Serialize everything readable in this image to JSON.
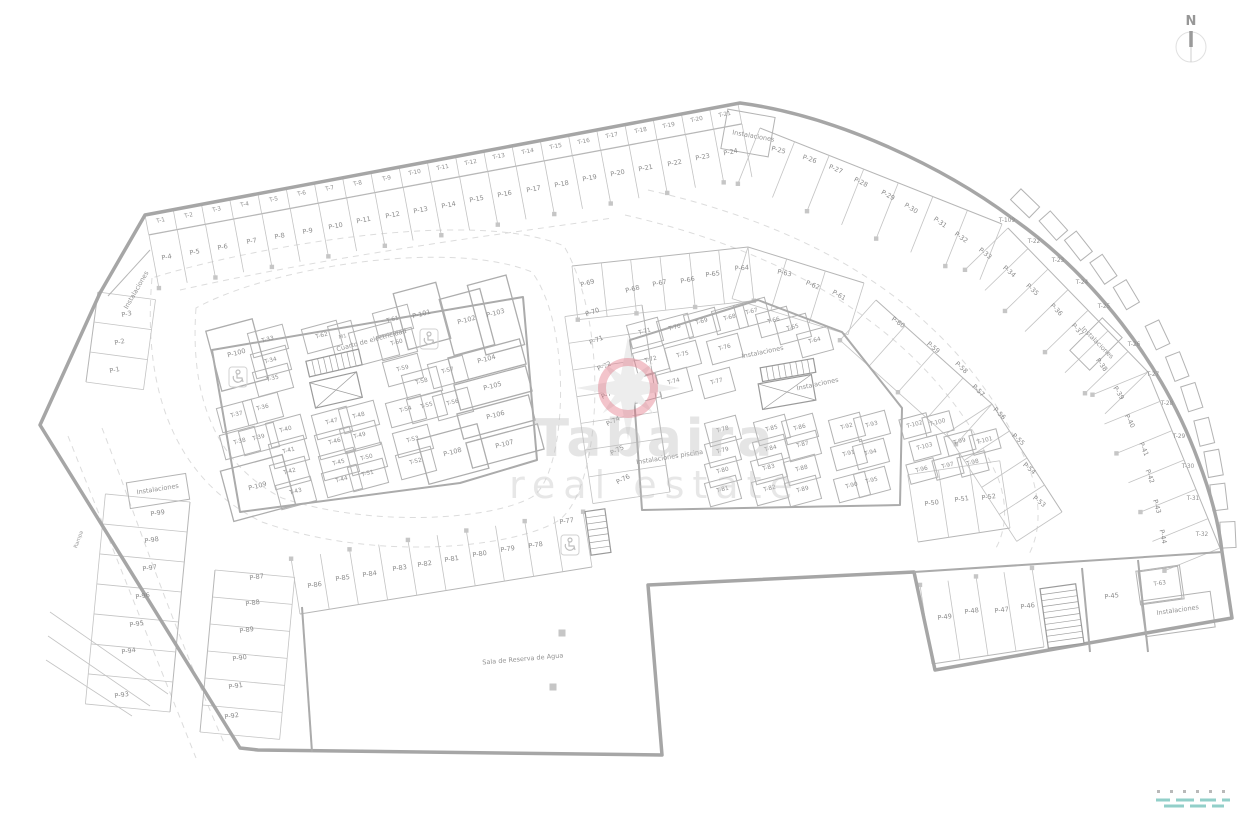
{
  "watermark": {
    "name": "Tabaira",
    "tagline": "real estate"
  },
  "compass": {
    "label": "N"
  },
  "plan": {
    "parking": [
      [
        "P-1",
        115,
        372,
        -12
      ],
      [
        "P-2",
        120,
        344,
        -12
      ],
      [
        "P-3",
        127,
        316,
        -12
      ],
      [
        "P-4",
        167,
        259,
        -11
      ],
      [
        "P-5",
        195,
        254,
        -11
      ],
      [
        "P-6",
        223,
        249,
        -11
      ],
      [
        "P-7",
        252,
        243,
        -11
      ],
      [
        "P-8",
        280,
        238,
        -11
      ],
      [
        "P-9",
        308,
        233,
        -11
      ],
      [
        "P-10",
        336,
        228,
        -11
      ],
      [
        "P-11",
        364,
        222,
        -11
      ],
      [
        "P-12",
        393,
        217,
        -11
      ],
      [
        "P-13",
        421,
        212,
        -11
      ],
      [
        "P-14",
        449,
        207,
        -11
      ],
      [
        "P-15",
        477,
        201,
        -11
      ],
      [
        "P-16",
        505,
        196,
        -11
      ],
      [
        "P-17",
        534,
        191,
        -11
      ],
      [
        "P-18",
        562,
        186,
        -11
      ],
      [
        "P-19",
        590,
        180,
        -11
      ],
      [
        "P-20",
        618,
        175,
        -11
      ],
      [
        "P-21",
        646,
        170,
        -11
      ],
      [
        "P-22",
        675,
        165,
        -11
      ],
      [
        "P-23",
        703,
        159,
        -11
      ],
      [
        "P-24",
        731,
        154,
        -11
      ],
      [
        "P-25",
        778,
        152,
        14
      ],
      [
        "P-26",
        809,
        161,
        18
      ],
      [
        "P-27",
        835,
        171,
        22
      ],
      [
        "P-28",
        860,
        184,
        26
      ],
      [
        "P-29",
        887,
        197,
        29
      ],
      [
        "P-30",
        910,
        210,
        32
      ],
      [
        "P-31",
        939,
        224,
        35
      ],
      [
        "P-32",
        960,
        239,
        36
      ],
      [
        "P-33",
        984,
        255,
        38
      ],
      [
        "P-34",
        1008,
        273,
        40
      ],
      [
        "P-35",
        1031,
        291,
        43
      ],
      [
        "P-36",
        1055,
        311,
        46
      ],
      [
        "P-37",
        1076,
        331,
        49
      ],
      [
        "P-38",
        1100,
        366,
        53
      ],
      [
        "P-39",
        1117,
        394,
        58
      ],
      [
        "P-40",
        1128,
        422,
        62
      ],
      [
        "P-41",
        1142,
        450,
        66
      ],
      [
        "P-42",
        1148,
        477,
        70
      ],
      [
        "P-43",
        1155,
        507,
        74
      ],
      [
        "P-44",
        1161,
        537,
        78
      ],
      [
        "P-45",
        1112,
        598,
        -8
      ],
      [
        "P-46",
        1028,
        608,
        -8
      ],
      [
        "P-47",
        1002,
        612,
        -8
      ],
      [
        "P-48",
        972,
        613,
        -8
      ],
      [
        "P-49",
        945,
        619,
        -8
      ],
      [
        "P-50",
        932,
        505,
        -8
      ],
      [
        "P-51",
        962,
        501,
        -8
      ],
      [
        "P-52",
        989,
        499,
        -8
      ],
      [
        "P-53",
        1038,
        503,
        38
      ],
      [
        "P-54",
        1028,
        470,
        40
      ],
      [
        "P-55",
        1017,
        441,
        42
      ],
      [
        "P-56",
        998,
        415,
        44
      ],
      [
        "P-57",
        977,
        392,
        45
      ],
      [
        "P-58",
        960,
        369,
        43
      ],
      [
        "P-59",
        932,
        349,
        40
      ],
      [
        "P-60",
        897,
        324,
        36
      ],
      [
        "P-61",
        838,
        297,
        30
      ],
      [
        "P-62",
        812,
        287,
        22
      ],
      [
        "P-63",
        784,
        275,
        12
      ],
      [
        "P-64",
        742,
        270,
        -4
      ],
      [
        "P-65",
        713,
        276,
        -8
      ],
      [
        "P-66",
        688,
        282,
        -11
      ],
      [
        "P-67",
        660,
        285,
        -13
      ],
      [
        "P-68",
        633,
        291,
        -15
      ],
      [
        "P-69",
        588,
        285,
        -16
      ],
      [
        "P-70",
        593,
        314,
        -20
      ],
      [
        "P-71",
        597,
        342,
        -22
      ],
      [
        "P-72",
        605,
        368,
        -24
      ],
      [
        "P-73",
        609,
        396,
        -25
      ],
      [
        "P-74",
        614,
        423,
        -26
      ],
      [
        "P-75",
        618,
        452,
        -27
      ],
      [
        "P-76",
        624,
        481,
        -28
      ],
      [
        "P-77",
        567,
        523,
        -9
      ],
      [
        "P-78",
        536,
        547,
        -9
      ],
      [
        "P-79",
        508,
        551,
        -9
      ],
      [
        "P-80",
        480,
        556,
        -9
      ],
      [
        "P-81",
        452,
        561,
        -9
      ],
      [
        "P-82",
        425,
        566,
        -9
      ],
      [
        "P-83",
        400,
        570,
        -9
      ],
      [
        "P-84",
        370,
        576,
        -9
      ],
      [
        "P-85",
        343,
        580,
        -9
      ],
      [
        "P-86",
        315,
        587,
        -9
      ],
      [
        "P-87",
        257,
        579,
        -9
      ],
      [
        "P-88",
        253,
        605,
        -9
      ],
      [
        "P-89",
        247,
        632,
        -9
      ],
      [
        "P-90",
        240,
        660,
        -9
      ],
      [
        "P-91",
        236,
        688,
        -9
      ],
      [
        "P-92",
        232,
        718,
        -9
      ],
      [
        "P-93",
        122,
        697,
        -9
      ],
      [
        "P-94",
        129,
        653,
        -9
      ],
      [
        "P-95",
        137,
        626,
        -9
      ],
      [
        "P-96",
        143,
        598,
        -9
      ],
      [
        "P-97",
        150,
        570,
        -9
      ],
      [
        "P-98",
        152,
        542,
        -9
      ],
      [
        "P-99",
        158,
        515,
        -9
      ],
      [
        "P-100",
        237,
        355,
        -15
      ],
      [
        "P-101",
        422,
        316,
        -15
      ],
      [
        "P-102",
        467,
        322,
        -15
      ],
      [
        "P-103",
        496,
        315,
        -15
      ],
      [
        "P-104",
        487,
        361,
        -15
      ],
      [
        "P-105",
        493,
        388,
        -15
      ],
      [
        "P-106",
        496,
        417,
        -15
      ],
      [
        "P-107",
        505,
        446,
        -15
      ],
      [
        "P-108",
        453,
        454,
        -15
      ],
      [
        "P-109",
        258,
        488,
        -15
      ]
    ],
    "storage": [
      [
        "T-1",
        161,
        222,
        -11
      ],
      [
        "T-2",
        189,
        217,
        -11
      ],
      [
        "T-3",
        217,
        211,
        -11
      ],
      [
        "T-4",
        245,
        206,
        -11
      ],
      [
        "T-5",
        274,
        201,
        -11
      ],
      [
        "T-6",
        302,
        195,
        -11
      ],
      [
        "T-7",
        330,
        190,
        -11
      ],
      [
        "T-8",
        358,
        185,
        -11
      ],
      [
        "T-9",
        387,
        180,
        -11
      ],
      [
        "T-10",
        415,
        174,
        -11
      ],
      [
        "T-11",
        443,
        169,
        -11
      ],
      [
        "T-12",
        471,
        164,
        -11
      ],
      [
        "T-13",
        499,
        158,
        -11
      ],
      [
        "T-14",
        528,
        153,
        -11
      ],
      [
        "T-15",
        556,
        148,
        -11
      ],
      [
        "T-16",
        584,
        143,
        -11
      ],
      [
        "T-17",
        612,
        137,
        -11
      ],
      [
        "T-18",
        641,
        132,
        -11
      ],
      [
        "T-19",
        669,
        127,
        -11
      ],
      [
        "T-20",
        697,
        121,
        -11
      ],
      [
        "T-21",
        725,
        116,
        -11
      ],
      [
        "T-22",
        1034,
        243,
        0
      ],
      [
        "T-23",
        1058,
        262,
        0
      ],
      [
        "T-24",
        1082,
        284,
        0
      ],
      [
        "T-25",
        1104,
        308,
        0
      ],
      [
        "T-26",
        1134,
        346,
        0
      ],
      [
        "T-27",
        1153,
        376,
        0
      ],
      [
        "T-28",
        1167,
        405,
        0
      ],
      [
        "T-29",
        1179,
        438,
        0
      ],
      [
        "T-30",
        1188,
        468,
        0
      ],
      [
        "T-31",
        1193,
        500,
        0
      ],
      [
        "T-32",
        1202,
        536,
        0
      ],
      [
        "T-33",
        268,
        341,
        -15
      ],
      [
        "T-34",
        271,
        362,
        -15
      ],
      [
        "T-35",
        273,
        380,
        -15
      ],
      [
        "T-36",
        263,
        409,
        -15
      ],
      [
        "T-37",
        237,
        416,
        -15
      ],
      [
        "T-38",
        240,
        443,
        -15
      ],
      [
        "T-39",
        259,
        439,
        -15
      ],
      [
        "T-40",
        286,
        431,
        -15
      ],
      [
        "T-41",
        289,
        452,
        -15
      ],
      [
        "T-42",
        290,
        473,
        -15
      ],
      [
        "T-43",
        296,
        493,
        -15
      ],
      [
        "T-44",
        342,
        481,
        -15
      ],
      [
        "T-45",
        339,
        464,
        -15
      ],
      [
        "T-46",
        335,
        443,
        -15
      ],
      [
        "T-47",
        332,
        423,
        -15
      ],
      [
        "T-48",
        359,
        417,
        -15
      ],
      [
        "T-49",
        360,
        437,
        -15
      ],
      [
        "T-50",
        367,
        459,
        -15
      ],
      [
        "T-51",
        368,
        475,
        -15
      ],
      [
        "T-52",
        416,
        463,
        -15
      ],
      [
        "T-53",
        413,
        441,
        -15
      ],
      [
        "T-54",
        406,
        411,
        -15
      ],
      [
        "T-55",
        427,
        407,
        -15
      ],
      [
        "T-56",
        453,
        404,
        -15
      ],
      [
        "T-57",
        448,
        372,
        -15
      ],
      [
        "T-58",
        422,
        383,
        -15
      ],
      [
        "T-59",
        403,
        370,
        -15
      ],
      [
        "T-60",
        397,
        344,
        -15
      ],
      [
        "T-61",
        393,
        321,
        -15
      ],
      [
        "T-62",
        322,
        337,
        -15
      ],
      [
        "T-63",
        1160,
        585,
        -8
      ],
      [
        "T-64",
        815,
        342,
        -15
      ],
      [
        "T-65",
        793,
        329,
        -15
      ],
      [
        "T-66",
        774,
        322,
        -15
      ],
      [
        "T-67",
        752,
        313,
        -15
      ],
      [
        "T-68",
        730,
        319,
        -15
      ],
      [
        "T-69",
        702,
        323,
        -15
      ],
      [
        "T-70",
        675,
        329,
        -15
      ],
      [
        "T-71",
        645,
        333,
        -15
      ],
      [
        "T-72",
        651,
        361,
        -15
      ],
      [
        "T-73",
        643,
        389,
        -15
      ],
      [
        "T-74",
        674,
        383,
        -15
      ],
      [
        "T-75",
        683,
        356,
        -15
      ],
      [
        "T-76",
        725,
        349,
        -15
      ],
      [
        "T-77",
        717,
        383,
        -15
      ],
      [
        "T-78",
        723,
        431,
        -15
      ],
      [
        "T-79",
        723,
        452,
        -15
      ],
      [
        "T-80",
        723,
        472,
        -15
      ],
      [
        "T-81",
        723,
        491,
        -15
      ],
      [
        "T-82",
        770,
        490,
        -15
      ],
      [
        "T-83",
        769,
        469,
        -15
      ],
      [
        "T-84",
        771,
        450,
        -15
      ],
      [
        "T-85",
        772,
        430,
        -15
      ],
      [
        "T-86",
        800,
        429,
        -15
      ],
      [
        "T-87",
        803,
        446,
        -15
      ],
      [
        "T-88",
        802,
        470,
        -15
      ],
      [
        "T-89",
        803,
        491,
        -15
      ],
      [
        "T-90",
        852,
        487,
        -15
      ],
      [
        "T-91",
        849,
        455,
        -15
      ],
      [
        "T-92",
        847,
        428,
        -15
      ],
      [
        "T-93",
        872,
        426,
        -15
      ],
      [
        "T-94",
        871,
        454,
        -15
      ],
      [
        "T-95",
        872,
        482,
        -15
      ],
      [
        "T-96",
        922,
        471,
        -15
      ],
      [
        "T-97",
        948,
        467,
        -15
      ],
      [
        "T-98",
        973,
        464,
        -15
      ],
      [
        "T-99",
        960,
        443,
        -15
      ],
      [
        "T-100",
        938,
        424,
        -15
      ],
      [
        "T-101",
        985,
        442,
        -15
      ],
      [
        "T-102",
        915,
        426,
        -15
      ],
      [
        "T-103",
        925,
        448,
        -15
      ],
      [
        "T-109",
        1007,
        222,
        0
      ]
    ],
    "rooms": [
      [
        "Instalaciones",
        753,
        138,
        10
      ],
      [
        "Instalaciones",
        1096,
        344,
        45
      ],
      [
        "Instalaciones",
        763,
        354,
        -12
      ],
      [
        "Instalaciones",
        818,
        386,
        -12
      ],
      [
        "Instalaciones piscina",
        670,
        459,
        -9
      ],
      [
        "Sala de Reserva de Agua",
        523,
        661,
        -5
      ],
      [
        "Instalaciones",
        1178,
        612,
        -8
      ],
      [
        "Instalaciones",
        158,
        491,
        -9
      ],
      [
        "Instalaciones",
        138,
        291,
        -60
      ],
      [
        "Cuarto de electricidad",
        372,
        342,
        -15
      ],
      [
        "M1",
        343,
        338,
        -15
      ],
      [
        "Rampa",
        80,
        540,
        -70
      ]
    ],
    "accessible": [
      [
        238,
        377
      ],
      [
        429,
        339
      ],
      [
        570,
        545
      ]
    ]
  }
}
